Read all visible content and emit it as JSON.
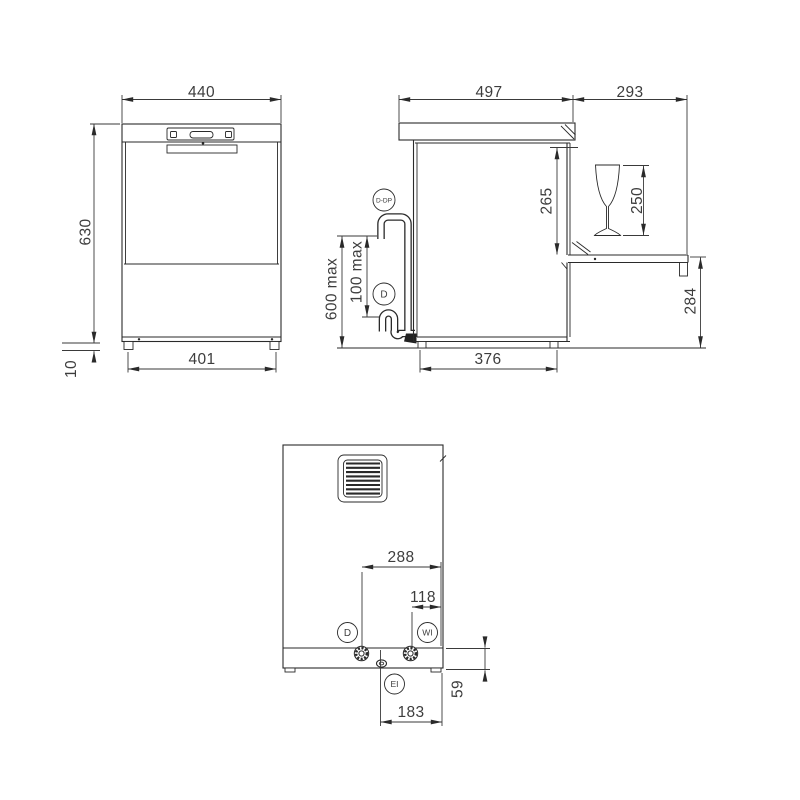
{
  "drawing": {
    "type": "dishwasher-dimension-drawing",
    "colors": {
      "line": "#2a2a2a",
      "text": "#3d3d3d",
      "background": "#ffffff"
    },
    "front": {
      "dims": {
        "overall_width": "440",
        "overall_height": "630",
        "base_width": "401",
        "feet_height": "10"
      }
    },
    "side": {
      "dims": {
        "body_depth": "497",
        "open_door_depth": "293",
        "chamber_height": "265",
        "glass_height": "250",
        "door_to_floor": "284",
        "base_depth": "376",
        "drain_hose_max": "600 max",
        "drain_hose_min": "100 max"
      },
      "labels": {
        "drain_pump": "D-DP",
        "drain": "D"
      }
    },
    "back": {
      "dims": {
        "drain_offset": "288",
        "water_inlet_offset": "118",
        "electrical_offset": "183",
        "connection_height": "59"
      },
      "labels": {
        "drain": "D",
        "water_inlet": "WI",
        "electrical_inlet": "EI"
      }
    }
  }
}
